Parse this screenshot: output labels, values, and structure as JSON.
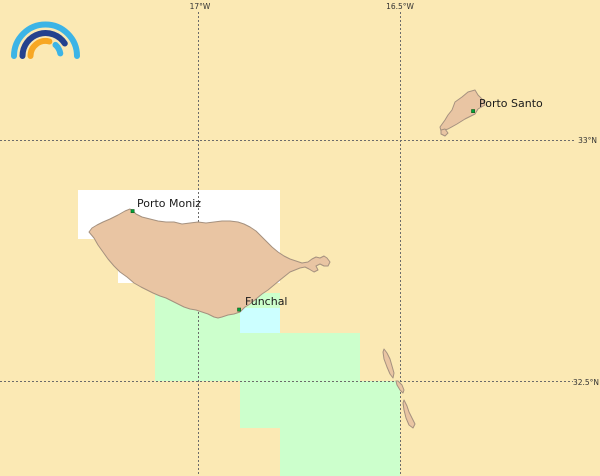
{
  "colors": {
    "ocean": "#fbe9b4",
    "land": "#e9c5a3",
    "land_border": "#a5917f",
    "tile_white": "#ffffff",
    "tile_green": "#ccffcc",
    "tile_cyan": "#ccffff",
    "grid": "#6b6b6b",
    "label": "#1a1a1a",
    "grid_label": "#333333",
    "marker_fill": "#00a33c",
    "marker_border": "#1a5c1a",
    "logo_light_blue": "#3cb4e6",
    "logo_dark_blue": "#24418e",
    "logo_orange": "#f7a723"
  },
  "grid": {
    "meridians": [
      {
        "label": "17°W"
      },
      {
        "label": "16.5°W"
      }
    ],
    "parallels": [
      {
        "label": "33°N"
      },
      {
        "label": "32.5°N"
      }
    ]
  },
  "places": [
    {
      "name": "Porto Moniz"
    },
    {
      "name": "Funchal"
    },
    {
      "name": "Porto Santo"
    }
  ],
  "logo": {
    "name": "rainbow-arcs-logo"
  }
}
